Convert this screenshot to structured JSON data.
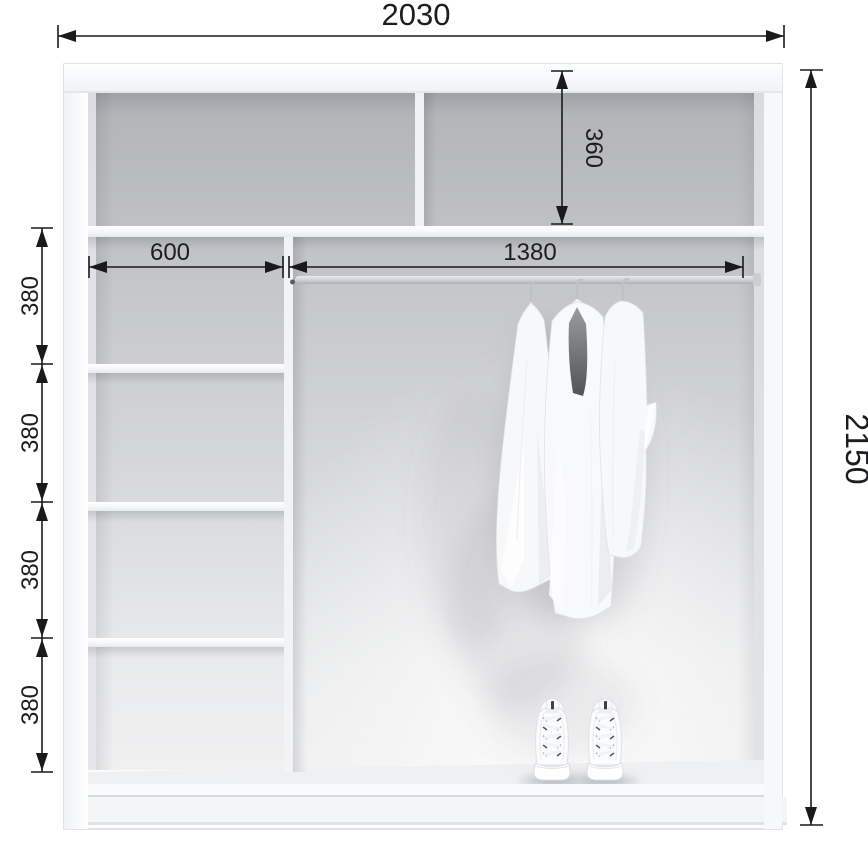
{
  "page": {
    "kind": "wardrobe-interior-dimension-diagram",
    "background": "#ffffff"
  },
  "dimensions": {
    "total_width": "2030",
    "total_height": "2150",
    "top_section_height": "360",
    "left_column_width": "600",
    "hanging_rod_width": "1380",
    "shelf_spacings": [
      "380",
      "380",
      "380",
      "380"
    ]
  },
  "objects": {
    "garments_on_hangers": "3",
    "shoe_pairs": "1"
  },
  "colors": {
    "dimension_line": "#1a1a1c",
    "back_wall": "#c6c7cb",
    "panel": "#f6f7f9",
    "rod": "#cfd2d6"
  }
}
